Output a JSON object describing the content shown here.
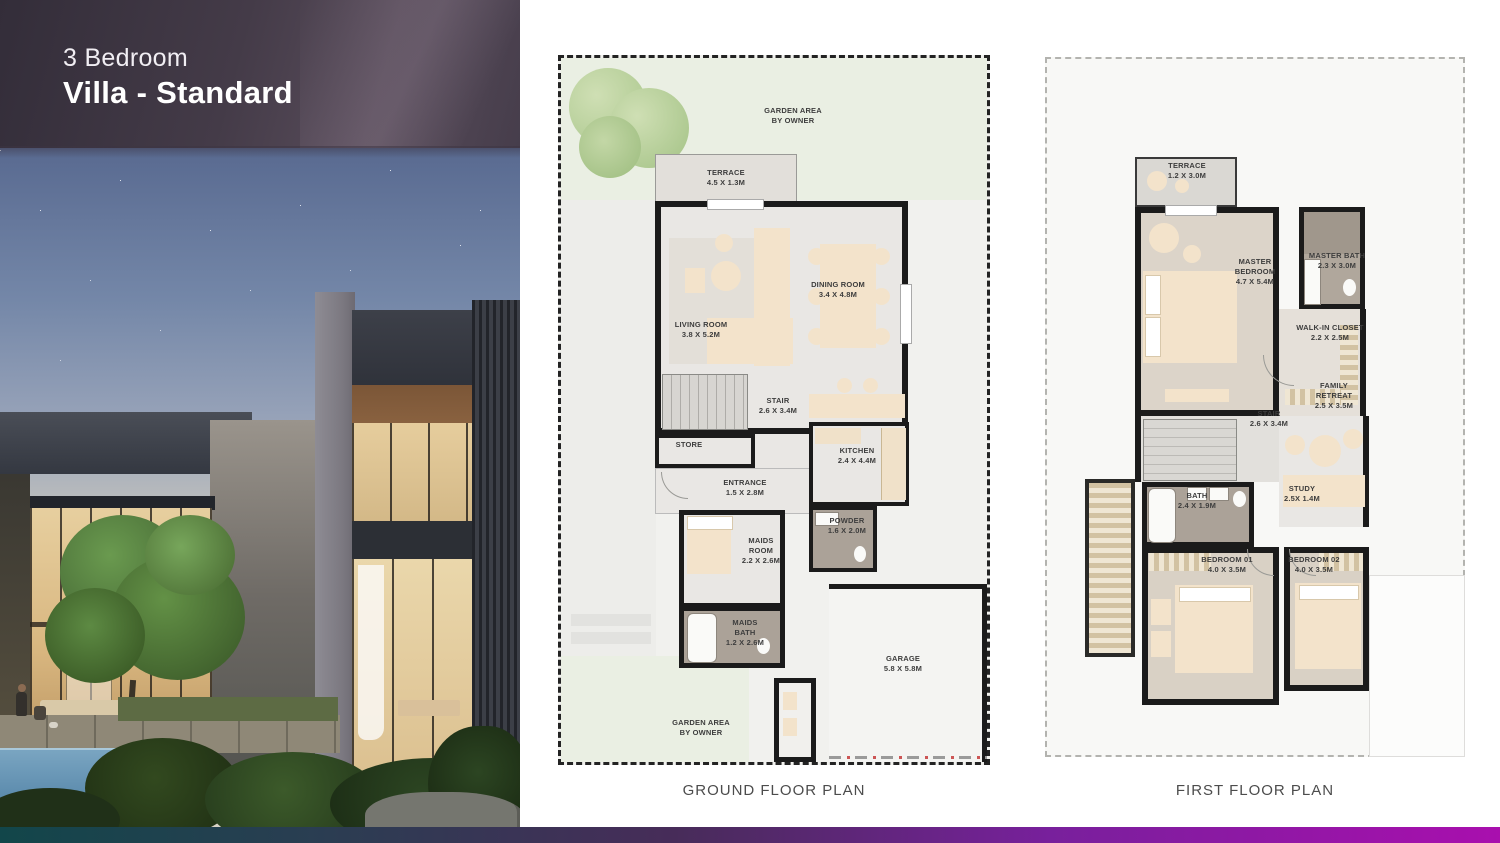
{
  "header": {
    "subtitle": "3 Bedroom",
    "title": "Villa - Standard"
  },
  "ground_floor": {
    "caption": "GROUND FLOOR PLAN",
    "rooms": [
      {
        "name": "GARDEN AREA",
        "dims": "BY OWNER"
      },
      {
        "name": "TERRACE",
        "dims": "4.5 X 1.3M"
      },
      {
        "name": "LIVING ROOM",
        "dims": "3.8 X 5.2M"
      },
      {
        "name": "DINING ROOM",
        "dims": "3.4 X 4.8M"
      },
      {
        "name": "STAIR",
        "dims": "2.6 X 3.4M"
      },
      {
        "name": "STORE",
        "dims": ""
      },
      {
        "name": "KITCHEN",
        "dims": "2.4 X 4.4M"
      },
      {
        "name": "ENTRANCE",
        "dims": "1.5 X 2.8M"
      },
      {
        "name": "POWDER",
        "dims": "1.6 X 2.0M"
      },
      {
        "name": "MAIDS ROOM",
        "dims": "2.2 X 2.6M"
      },
      {
        "name": "MAIDS BATH",
        "dims": "1.2 X 2.6M"
      },
      {
        "name": "GARAGE",
        "dims": "5.8 X 5.8M"
      },
      {
        "name": "GARDEN AREA",
        "dims": "BY OWNER"
      }
    ]
  },
  "first_floor": {
    "caption": "FIRST FLOOR PLAN",
    "rooms": [
      {
        "name": "TERRACE",
        "dims": "1.2 X 3.0M"
      },
      {
        "name": "MASTER BEDROOM",
        "dims": "4.7 X 5.4M"
      },
      {
        "name": "MASTER BATH",
        "dims": "2.3 X 3.0M"
      },
      {
        "name": "WALK-IN CLOSET",
        "dims": "2.2 X 2.5M"
      },
      {
        "name": "FAMILY RETREAT",
        "dims": "2.5 X 3.5M"
      },
      {
        "name": "STAIR",
        "dims": "2.6 X 3.4M"
      },
      {
        "name": "BATH",
        "dims": "2.4 X 1.9M"
      },
      {
        "name": "STUDY",
        "dims": "2.5X 1.4M"
      },
      {
        "name": "BEDROOM 01",
        "dims": "4.0 X 3.5M"
      },
      {
        "name": "BEDROOM 02",
        "dims": "4.0 X 3.5M"
      }
    ]
  },
  "colors": {
    "accent_bar_gradient": [
      "#12464a",
      "#2b3d52",
      "#472c59",
      "#78209c",
      "#a90fae"
    ],
    "plan_wall": "#1b1b1b",
    "garden_green": "#eaefe3",
    "plan_floor": "#e9e7e4",
    "bedroom_carpet": "#d9d1c5",
    "bath_tile": "#aba298",
    "furniture_beige": "#f3e3cb",
    "title_text": "#ffffff",
    "caption_text": "#4c4c4c"
  }
}
